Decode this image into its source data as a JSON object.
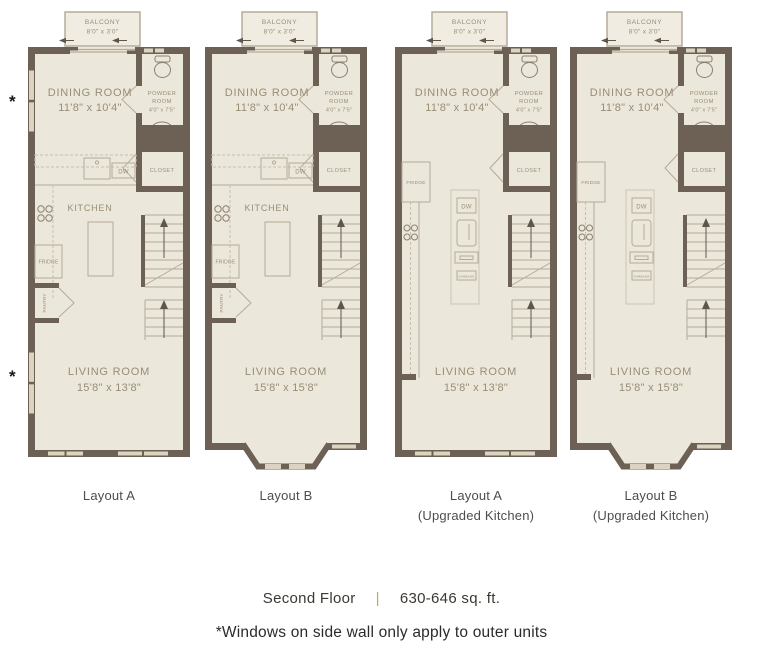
{
  "title": "Second floor unit floor plans",
  "colors": {
    "wall": "#6c6154",
    "floor": "#ece7db",
    "balcony_floor": "#f0ece2",
    "window": "#dbd4c1",
    "line": "#b5ab97",
    "dash": "#c8bfab",
    "island_outline": "#cdc4b0",
    "fixture": "#8a8070",
    "room_text": "#998d75",
    "arrow": "#5f564b",
    "caption_text": "#4d4d4d",
    "footer_text": "#3c3833",
    "separator_gold": "#c9a452",
    "footnote_text": "#2b2b2b"
  },
  "plan_labels": {
    "balcony": "BALCONY",
    "balcony_dims": "8'0\" x 3'0\"",
    "dining_room": "DINING ROOM",
    "dining_room_dims": "11'8\" x 10'4\"",
    "powder_room_line1": "POWDER",
    "powder_room_line2": "ROOM",
    "powder_room_dims": "4'0\" x 7'5\"",
    "closet": "CLOSET",
    "kitchen": "KITCHEN",
    "living_room": "LIVING ROOM",
    "dw": "DW",
    "fridge": "FRIDGE",
    "pantry": "PANTRY",
    "garbage": "GARBAGE"
  },
  "plans": [
    {
      "id": "layout-a",
      "caption_lines": [
        "Layout A"
      ],
      "living_room_dims": "15'8\" x 13'8\"",
      "kitchen_style": "standard",
      "bay_window": false,
      "side_wall_windows": true
    },
    {
      "id": "layout-b",
      "caption_lines": [
        "Layout B"
      ],
      "living_room_dims": "15'8\" x 15'8\"",
      "kitchen_style": "standard",
      "bay_window": true,
      "side_wall_windows": false
    },
    {
      "id": "layout-a-upgraded",
      "caption_lines": [
        "Layout A",
        "(Upgraded Kitchen)"
      ],
      "living_room_dims": "15'8\" x 13'8\"",
      "kitchen_style": "upgraded",
      "bay_window": false,
      "side_wall_windows": false
    },
    {
      "id": "layout-b-upgraded",
      "caption_lines": [
        "Layout B",
        "(Upgraded Kitchen)"
      ],
      "living_room_dims": "15'8\" x 15'8\"",
      "kitchen_style": "upgraded",
      "bay_window": true,
      "side_wall_windows": false
    }
  ],
  "asterisk_symbol": "*",
  "footer": {
    "floor_label": "Second Floor",
    "separator": "|",
    "area_label": "630-646 sq. ft."
  },
  "footnote": "*Windows on side wall only apply to outer units"
}
